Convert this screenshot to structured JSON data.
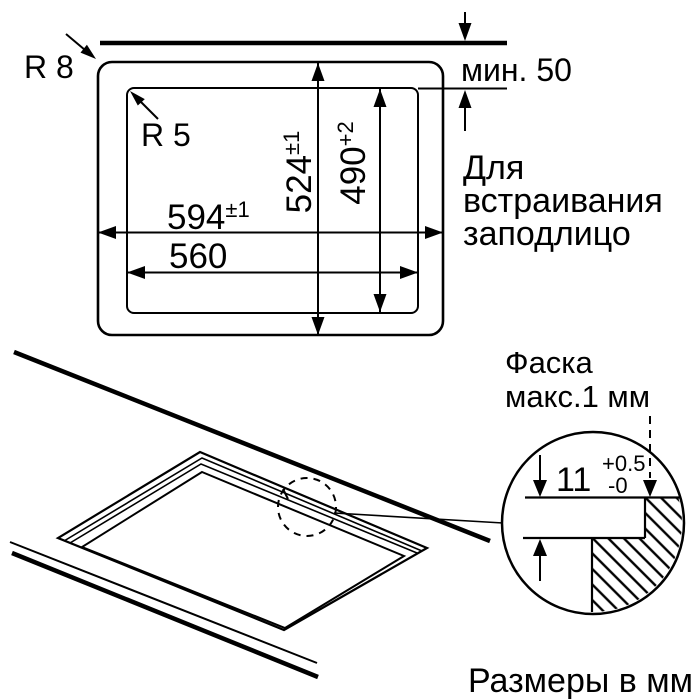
{
  "page": {
    "background": "#ffffff",
    "ink": "#000000",
    "description": "Installation diagram for flush-mounted built-in hob, dimensions in mm"
  },
  "plan_view": {
    "corner_radius_outer_label": "R 8",
    "corner_radius_inner_label": "R 5",
    "min_distance_label": "мин. 50",
    "width_outer": {
      "value": "594",
      "tolerance": "±1"
    },
    "width_inner": {
      "value": "560"
    },
    "height_outer": {
      "value": "524",
      "tolerance": "±1"
    },
    "height_inner": {
      "value": "490",
      "tolerance": "+2"
    },
    "flush_note": {
      "line1": "Для",
      "line2": "встраивания",
      "line3": "заподлицо"
    }
  },
  "detail_view": {
    "chamfer_note": {
      "line1": "Фаска",
      "line2": "макс.1 мм"
    },
    "depth": {
      "value": "11",
      "tolerance_plus": "+0.5",
      "tolerance_minus": "-0"
    }
  },
  "footer": {
    "units_note": "Размеры в мм"
  }
}
